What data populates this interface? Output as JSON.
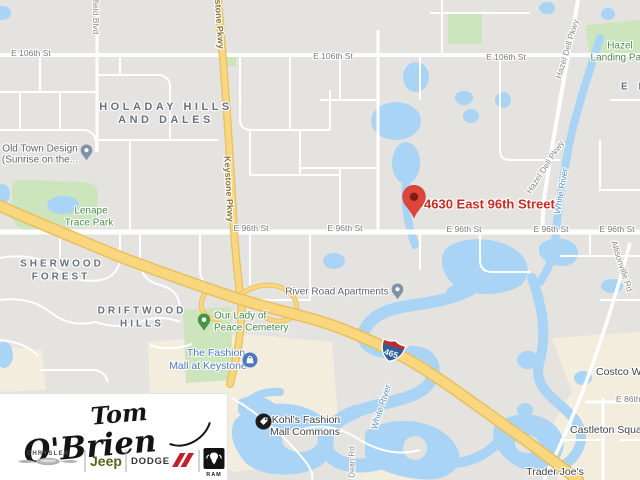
{
  "marker": {
    "address": "4630 East 96th Street"
  },
  "highway_shield": {
    "number": "465"
  },
  "streets": {
    "e106": "E 106th St",
    "e96": "E 96th St",
    "e86": "E 86th St",
    "keystone": "Keystone Pkwy",
    "westfield_partial": "field Blvd",
    "hazel_dell": "Hazel Dell Pkwy",
    "allisonville": "Allisonville Rd",
    "dean": "Dean Rd",
    "white_river": "White River"
  },
  "neighborhoods": {
    "holaday": [
      "HOLADAY HILLS",
      "AND DALES"
    ],
    "sherwood": [
      "SHERWOOD",
      "FOREST"
    ],
    "driftwood": [
      "DRIFTWOOD",
      "HILLS"
    ],
    "el_partial": "E L"
  },
  "places": {
    "old_town": [
      "Old Town Design",
      "(Sunrise on the..."
    ],
    "lenape": [
      "Lenape",
      "Trace Park"
    ],
    "hazel_landing": [
      "Hazel",
      "Landing Park"
    ],
    "cemetery": [
      "Our Lady of",
      "Peace Cemetery"
    ],
    "fashion_mall": [
      "The Fashion",
      "Mall at Keystone"
    ],
    "river_road_apartments": "River Road Apartments",
    "kohls": [
      "Kohl's Fashion",
      "Mall Commons"
    ],
    "costco": "Costco Wholesale",
    "castleton": "Castleton Square",
    "trader_joes": "Trader Joe's"
  },
  "dealership_logo": {
    "name_line1": "Tom",
    "name_line2": "O'Brien",
    "brands": {
      "chrysler": "CHRYSLER",
      "jeep": "Jeep",
      "dodge": "DODGE",
      "ram": "RAM"
    }
  },
  "colors": {
    "map_background": "#e5e3df",
    "road_minor": "#ffffff",
    "highway_yellow": "#f9d77e",
    "water": "#aad4f5",
    "park_green": "#cde5bd",
    "commercial_beige": "#f2eddc",
    "marker_red": "#dd453a",
    "address_red": "#cb2b23"
  }
}
